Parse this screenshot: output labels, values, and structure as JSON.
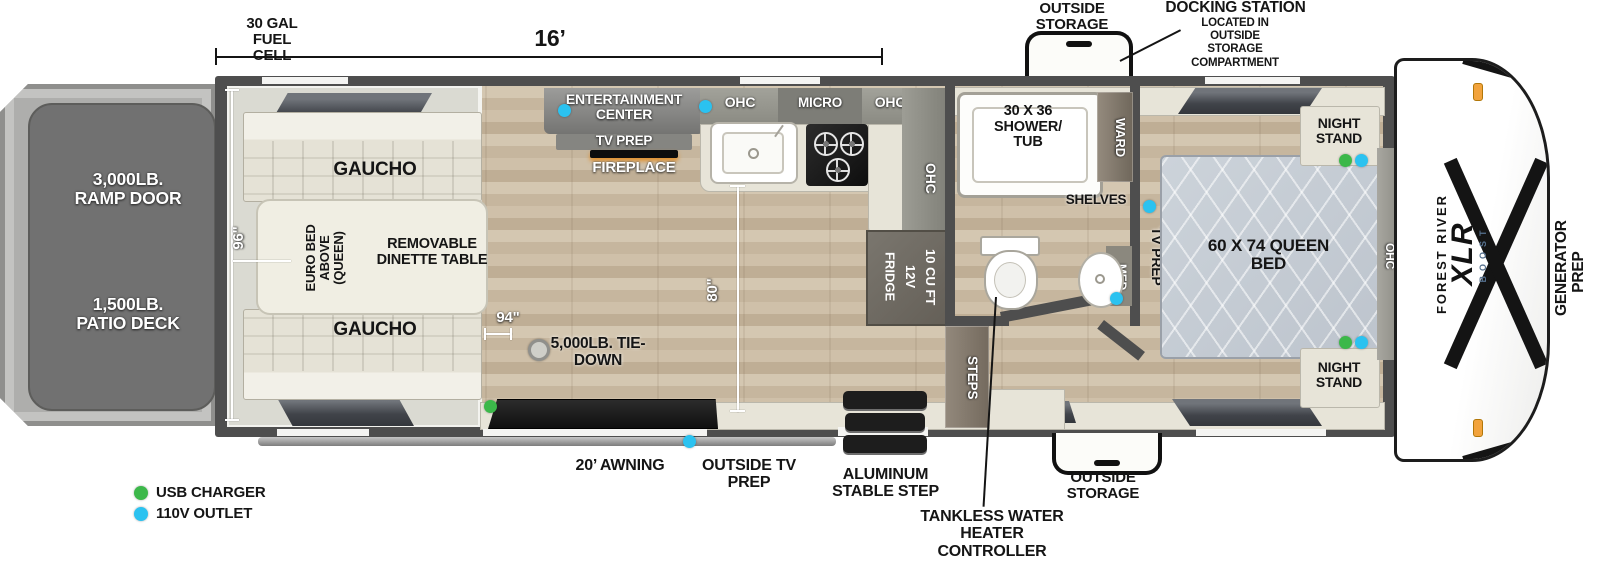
{
  "colors": {
    "usb": "#3cb84a",
    "outlet": "#2bc2f0"
  },
  "legend": {
    "usb": "USB CHARGER",
    "outlet": "110V OUTLET"
  },
  "top": {
    "fuel_cell": "30 GAL FUEL CELL",
    "length": "16’",
    "outside_storage": "OUTSIDE STORAGE",
    "docking_title": "DOCKING STATION",
    "docking_sub": "LOCATED IN OUTSIDE STORAGE COMPARTMENT"
  },
  "rear": {
    "ramp_door": "3,000LB. RAMP DOOR",
    "patio_deck": "1,500LB. PATIO DECK"
  },
  "garage": {
    "gaucho_top": "GAUCHO",
    "gaucho_bottom": "GAUCHO",
    "euro_bed": "EURO BED ABOVE (QUEEN)",
    "dinette": "REMOVABLE DINETTE TABLE",
    "tie_down": "5,000LB. TIE-DOWN",
    "dim_96": "96\"",
    "dim_94": "94\"",
    "dim_80": "80\""
  },
  "living": {
    "entertainment": "ENTERTAINMENT CENTER",
    "tv_prep": "TV PREP",
    "fireplace": "FIREPLACE"
  },
  "kitchen": {
    "ohc_left": "OHC",
    "micro": "MICRO",
    "ohc_right": "OHC",
    "ohc_tall": "OHC",
    "fridge": [
      "10 CU FT",
      "12V",
      "FRIDGE"
    ],
    "steps": "STEPS"
  },
  "bath": {
    "shower": "30 X 36 SHOWER/ TUB",
    "ward": "WARD",
    "shelves": "SHELVES",
    "med": "MED"
  },
  "bedroom": {
    "tv_prep": "TV PREP",
    "queen_bed": "60 X 74 QUEEN BED",
    "night_stand_top": "NIGHT STAND",
    "night_stand_bottom": "NIGHT STAND",
    "ohc": "OHC"
  },
  "front": {
    "maker": "FOREST RIVER",
    "model": "XLR",
    "sub": "BOOST",
    "generator_1": "GENERATOR",
    "generator_2": "PREP"
  },
  "bottom": {
    "awning": "20’ AWNING",
    "outside_tv": "OUTSIDE TV PREP",
    "stable_step": "ALUMINUM STABLE STEP",
    "tankless": "TANKLESS WATER HEATER CONTROLLER",
    "outside_storage": "OUTSIDE STORAGE"
  }
}
